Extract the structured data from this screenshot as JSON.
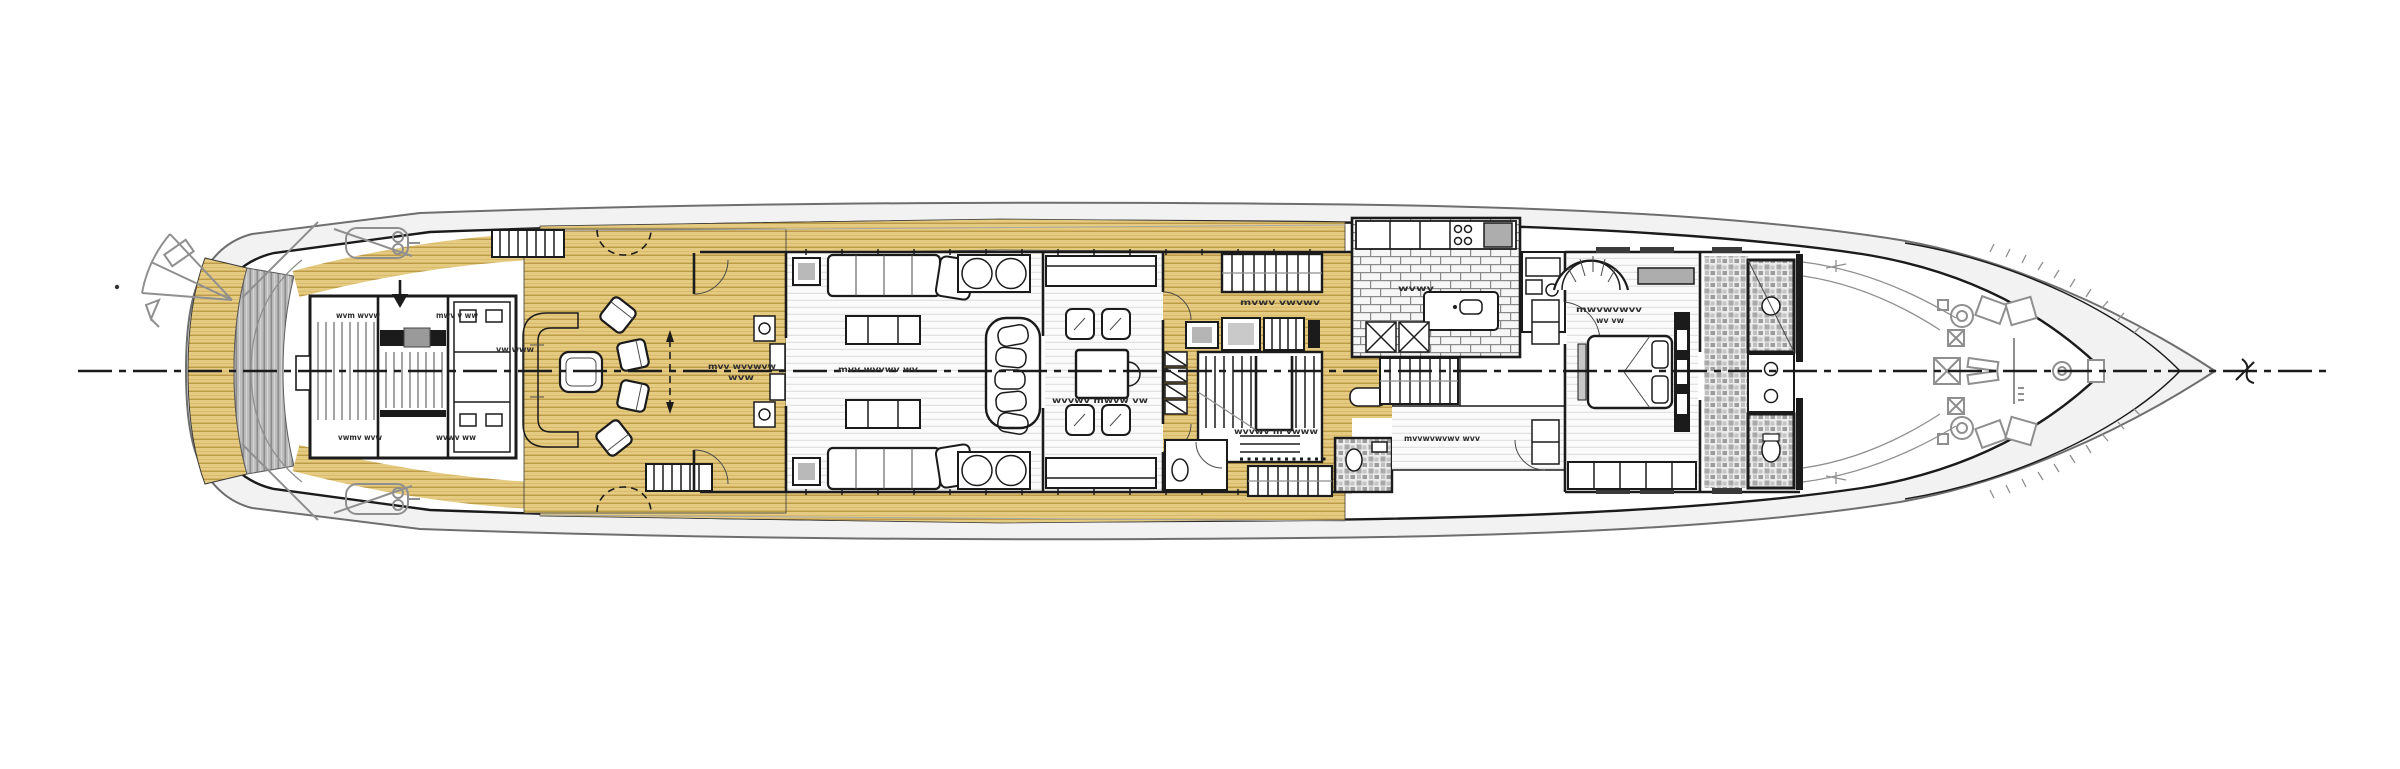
{
  "meta": {
    "drawing_type": "yacht main deck floor plan, top view, bow to the right",
    "background": "#FFFFFF"
  },
  "palette": {
    "ink": "#1B1B1B",
    "gray": "#8F8F8F",
    "teak": "#E5CB82",
    "teak-line": "#B9953F",
    "plank-line": "#DCDCDC",
    "gray-deck": "#BDBDBD",
    "tile-line": "#8A8A8A",
    "mosaic-dark": "#9C9C9C"
  },
  "labels": [
    {
      "id": "garage-top-left",
      "text": "wvm wvvw"
    },
    {
      "id": "garage-top-right",
      "text": "mwv v ww"
    },
    {
      "id": "garage-bottom-left",
      "text": "vwmv wvw"
    },
    {
      "id": "garage-bottom-right",
      "text": "wvwv ww"
    },
    {
      "id": "aft-deck-note",
      "text": "vw www"
    },
    {
      "id": "vestibule-note-1",
      "text": "mvv wvvwvw"
    },
    {
      "id": "vestibule-note-2",
      "text": "wvw"
    },
    {
      "id": "salon",
      "text": "mvv wvvwv wv"
    },
    {
      "id": "dining",
      "text": "wvvwv mwvw vw"
    },
    {
      "id": "lobby-top",
      "text": "mvwv vwvwv"
    },
    {
      "id": "lobby-bottom",
      "text": "wvvwv m vwww"
    },
    {
      "id": "galley",
      "text": "wvwv"
    },
    {
      "id": "corridor",
      "text": "mvvwvwvwv wvv"
    },
    {
      "id": "master-cabin-1",
      "text": "mwvwvwvv"
    },
    {
      "id": "master-cabin-2",
      "text": "wv vw"
    }
  ]
}
